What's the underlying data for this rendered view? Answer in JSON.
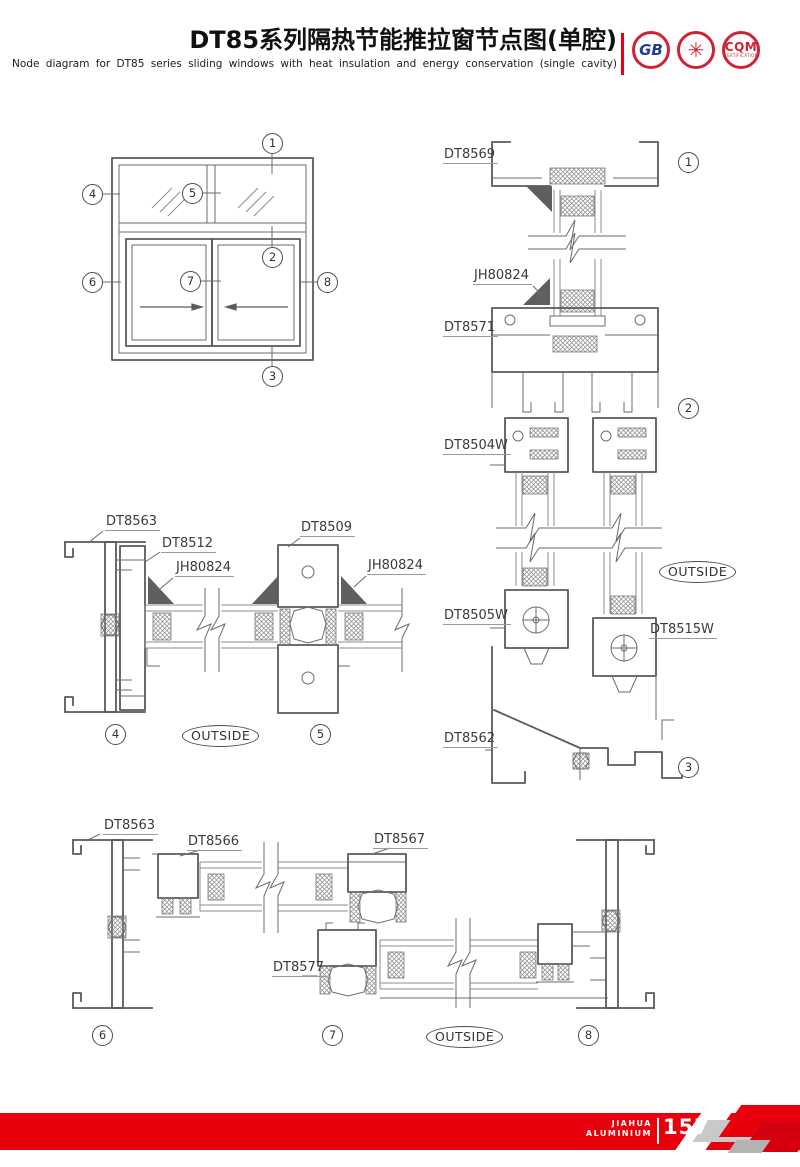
{
  "header": {
    "title_cn": "DT85系列隔热节能推拉窗节点图(单腔)",
    "title_en": "Node diagram for DT85 series sliding windows with heat insulation and energy conservation (single cavity)",
    "logos": [
      {
        "label": "GB"
      },
      {
        "label": "✳"
      },
      {
        "label": "CQM",
        "sub": "CERTIFICATION"
      }
    ]
  },
  "elevation": {
    "callouts": {
      "c1": "1",
      "c2": "2",
      "c3": "3",
      "c4": "4",
      "c5": "5",
      "c6": "6",
      "c7": "7",
      "c8": "8"
    }
  },
  "section_vertical": {
    "labels": {
      "head": "DT8569",
      "gasket": "JH80824",
      "transom": "DT8571",
      "sash_top": "DT8504W",
      "sash_bottom_left": "DT8505W",
      "sash_bottom_right": "DT8515W",
      "sill": "DT8562"
    },
    "callout_top": "1",
    "callout_mid": "2",
    "callout_bottom": "3",
    "outside": "OUTSIDE"
  },
  "section_horizontal_mid": {
    "labels": {
      "jamb": "DT8563",
      "sash_stile": "DT8512",
      "gasket_left": "JH80824",
      "interlock": "DT8509",
      "gasket_right": "JH80824"
    },
    "callout_left": "4",
    "callout_right": "5",
    "outside": "OUTSIDE"
  },
  "section_horizontal_bottom": {
    "labels": {
      "jamb": "DT8563",
      "sash_stile_left": "DT8566",
      "sash_stile_right": "DT8567",
      "lower_sash": "DT8577"
    },
    "callout_left": "6",
    "callout_mid": "7",
    "callout_right": "8",
    "outside": "OUTSIDE"
  },
  "footer": {
    "brand_line1": "JIAHUA",
    "brand_line2": "ALUMINIUM",
    "page_number": "157"
  },
  "colors": {
    "accent_red": "#e60012",
    "line_gray": "#5a5a5a",
    "label_text": "#3a3a3a"
  }
}
